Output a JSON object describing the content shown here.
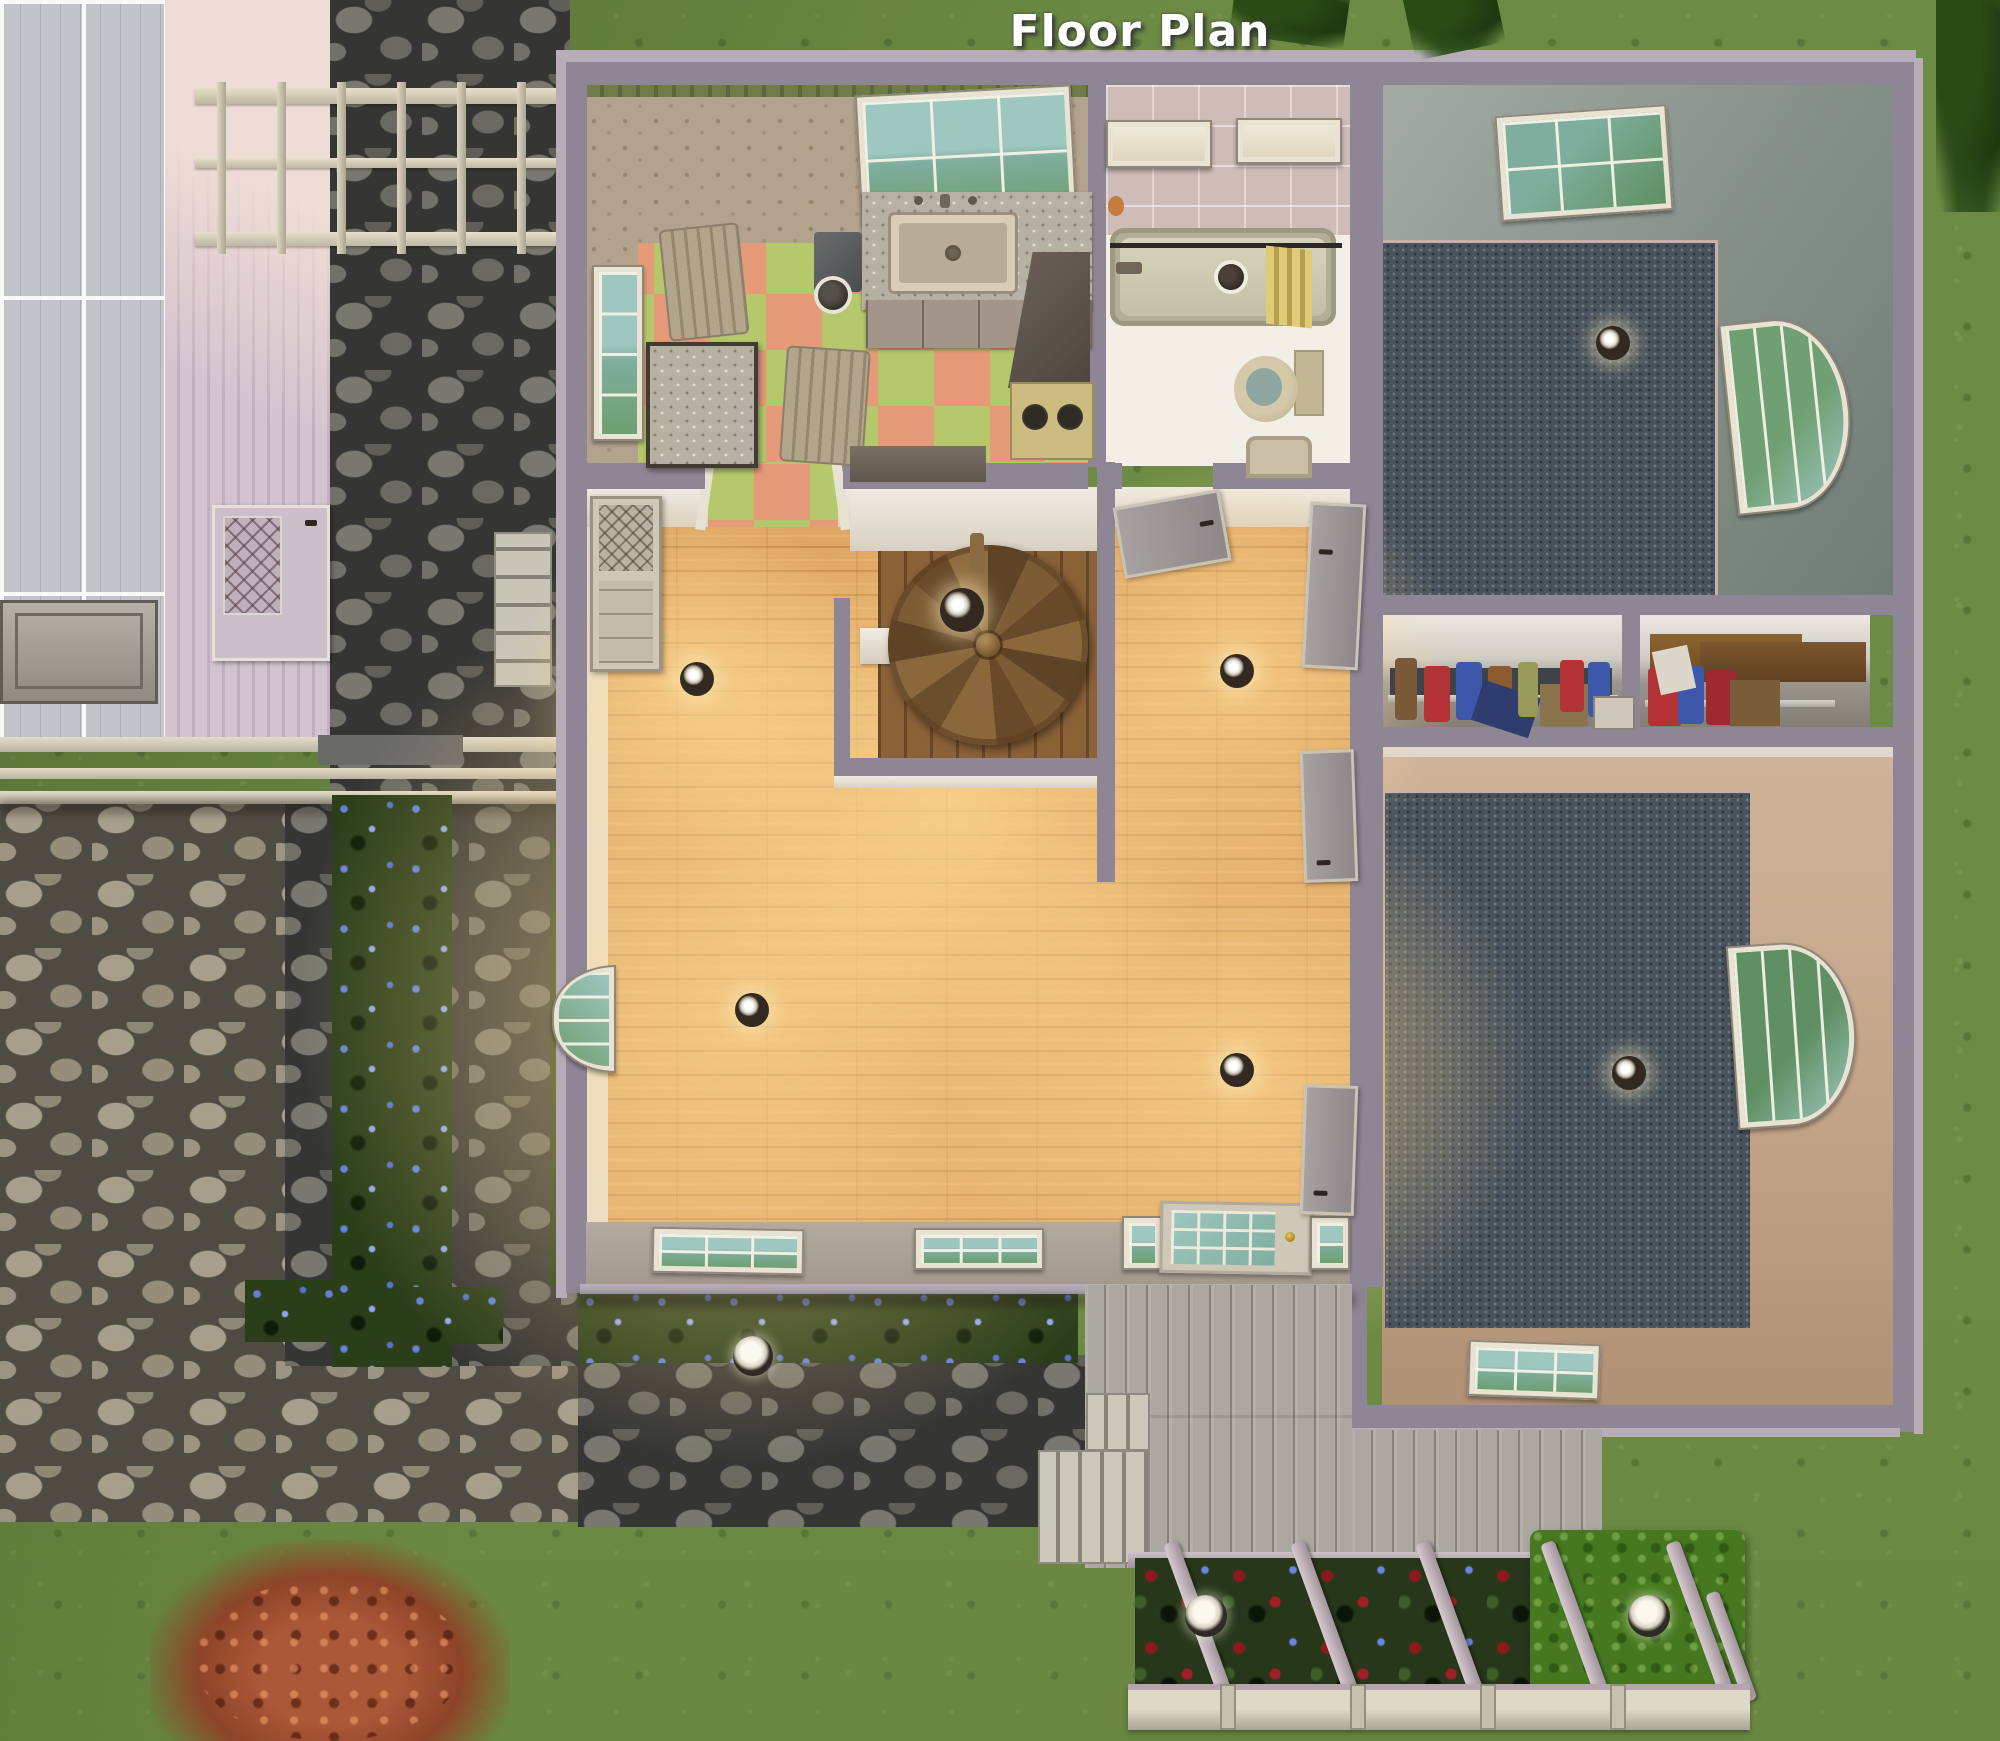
{
  "title": "Floor Plan",
  "palette": {
    "titlecolor": "#ffffff",
    "grass": "#6d8b44",
    "wall": "#8e8694",
    "wallrim": "#b6adb8",
    "roof": "#c3c4c8",
    "kitchenwall": "#b3a28e",
    "tilegreen": "#b5c86c",
    "tilesalmon": "#e59a79",
    "bathwall": "#cdbcb8",
    "bathfloor": "#f2efe7",
    "wood": "#dfa763",
    "carpet": "#49535d",
    "deck": "#aaa8a0",
    "flowerbed": "#2b3e1a",
    "rose": "#8e1a20",
    "hedge": "#46791f",
    "glass": "#9ec7c0"
  },
  "scene": {
    "view": "overhead floor plan of a house with yard",
    "rooms": [
      {
        "name": "kitchen",
        "floor": "green and salmon checkerboard",
        "walls": "tan vine wallpaper with green trim"
      },
      {
        "name": "bathroom",
        "floor": "white",
        "walls": "pink tile"
      },
      {
        "name": "bedroom-top-right",
        "floor": "dark blue carpet",
        "walls": "sage gray"
      },
      {
        "name": "living-room",
        "floor": "light wood",
        "walls": "cream"
      },
      {
        "name": "hallway",
        "floor": "light wood",
        "walls": "cream"
      },
      {
        "name": "closet-left",
        "contents": "hanging clothes on rod"
      },
      {
        "name": "closet-right",
        "contents": "hanging clothes and shelf"
      },
      {
        "name": "bedroom-bottom-right",
        "floor": "dark blue carpet",
        "walls": "tan"
      }
    ],
    "objects": [
      "spiral-staircase",
      "bathtub",
      "shower-curtain",
      "toilet",
      "bathroom-sink",
      "kitchen-sink",
      "kitchen-counter",
      "stove",
      "range-hood",
      "trash-can",
      "dining-table",
      "chair",
      "windows",
      "front-door",
      "interior-doors",
      "wardrobe",
      "ceiling-lights",
      "outdoor-lights",
      "wood-deck",
      "deck-steps",
      "rose-flower-bed",
      "blue-flower-beds",
      "hedge",
      "red-bush",
      "pergola",
      "fence",
      "stone-path",
      "neighbor-house",
      "ac-unit",
      "concrete-steps"
    ]
  }
}
